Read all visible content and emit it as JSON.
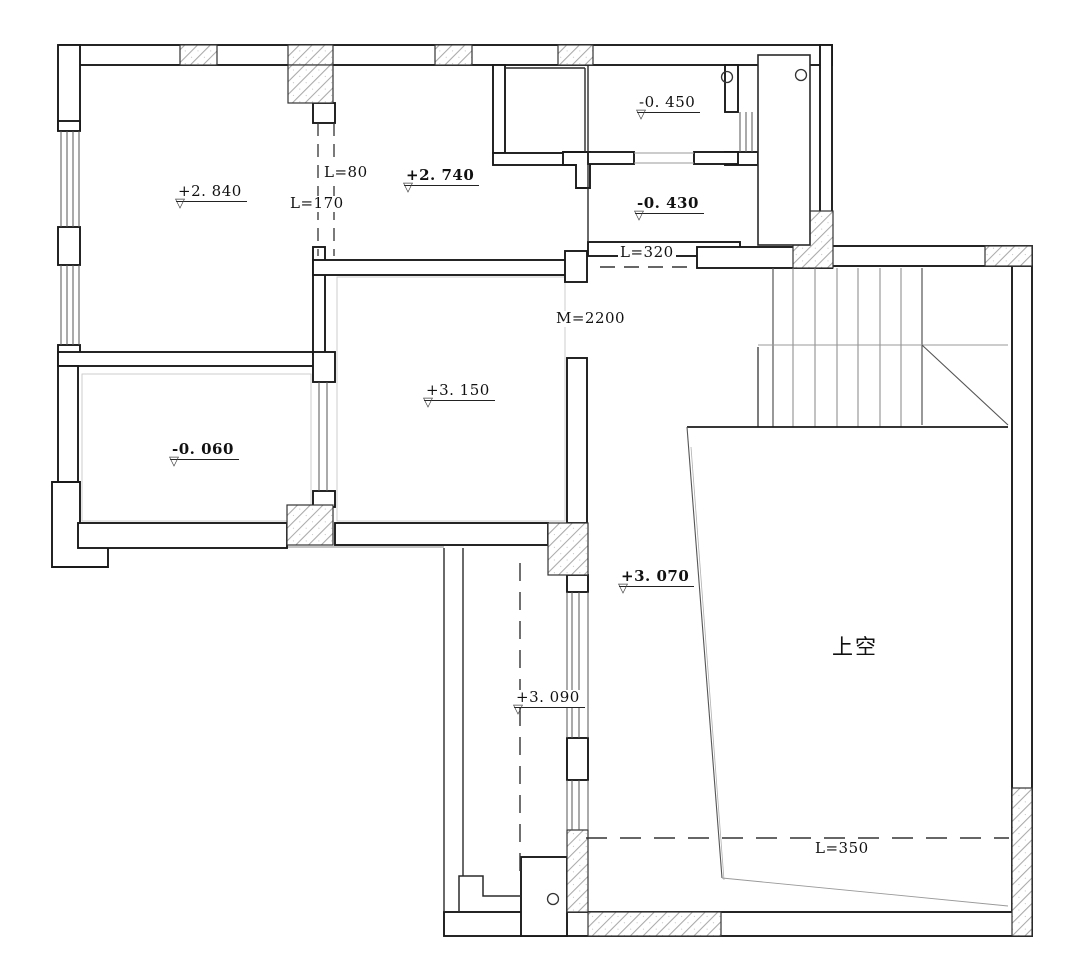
{
  "plan": {
    "marker_glyph": "▽",
    "elevation_labels": [
      {
        "text": "+2. 840",
        "weight": "regular"
      },
      {
        "text": "+2. 740",
        "weight": "bold"
      },
      {
        "text": "-0. 450",
        "weight": "regular"
      },
      {
        "text": "-0. 430",
        "weight": "bold"
      },
      {
        "text": "+3. 150",
        "weight": "regular"
      },
      {
        "text": "-0. 060",
        "weight": "bold"
      },
      {
        "text": "+3. 070",
        "weight": "bold"
      },
      {
        "text": "+3. 090",
        "weight": "regular"
      }
    ],
    "dimension_labels": [
      {
        "text": "L=80"
      },
      {
        "text": "L=170"
      },
      {
        "text": "L=320"
      },
      {
        "text": "M=2200"
      },
      {
        "text": "L=350"
      }
    ],
    "area_labels": [
      {
        "text": "上空"
      }
    ],
    "colors": {
      "background": "#ffffff",
      "wall_line": "#1a1a1a",
      "thin_line": "#8a8a8a",
      "hatch_line": "#a9a9a9",
      "dashed_line": "#333333"
    }
  }
}
